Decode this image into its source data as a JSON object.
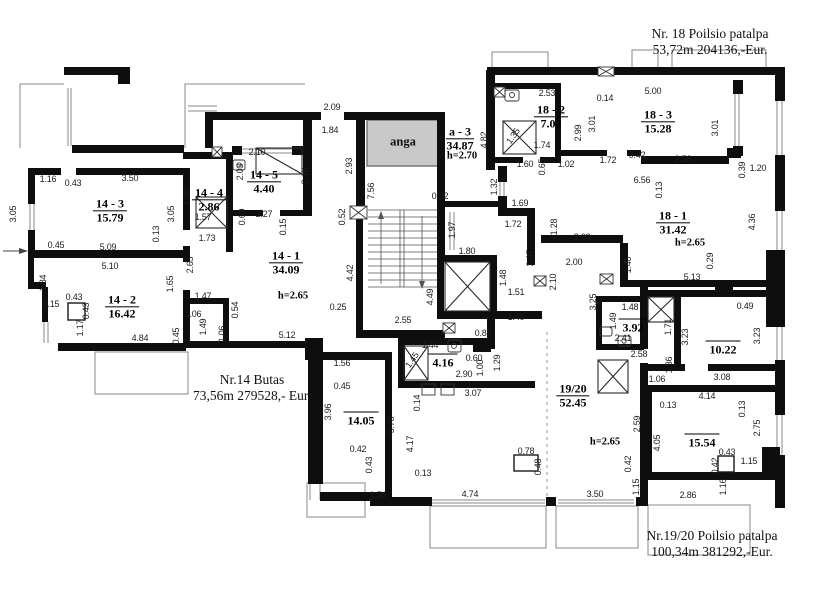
{
  "annotations": {
    "nr14": {
      "line1": "Nr.14 Butas",
      "line2": "73,56m 279528,- Eur."
    },
    "nr18": {
      "line1": "Nr. 18 Poilsio patalpa",
      "line2": "53,72m  204136,-Eur."
    },
    "nr1920": {
      "line1": "Nr.19/20 Poilsio patalpa",
      "line2": "100,34m  381292,-Eur."
    }
  },
  "niche": {
    "label": "anga",
    "x": 403,
    "y": 142
  },
  "rooms": [
    {
      "name": "14 - 3",
      "area": "15.79",
      "x": 110,
      "y": 211
    },
    {
      "name": "14 - 4",
      "area": "2.86",
      "x": 209,
      "y": 200
    },
    {
      "name": "14 - 5",
      "area": "4.40",
      "x": 264,
      "y": 182
    },
    {
      "name": "14 - 2",
      "area": "16.42",
      "x": 122,
      "y": 307
    },
    {
      "name": "14 - 1",
      "area": "34.09",
      "x": 286,
      "y": 263
    },
    {
      "name": "a - 3",
      "area": "34.87",
      "x": 460,
      "y": 139
    },
    {
      "name": "18 - 2",
      "area": "7.02",
      "x": 551,
      "y": 117
    },
    {
      "name": "18 - 3",
      "area": "15.28",
      "x": 658,
      "y": 122
    },
    {
      "name": "18 - 1",
      "area": "31.42",
      "x": 673,
      "y": 223
    },
    {
      "name": "19/20",
      "area": "52.45",
      "x": 573,
      "y": 396
    }
  ],
  "room_areas": [
    {
      "area": "14.05",
      "x": 361,
      "y": 420
    },
    {
      "area": "4.16",
      "x": 443,
      "y": 362
    },
    {
      "area": "3.92",
      "x": 633,
      "y": 327
    },
    {
      "area": "10.22",
      "x": 723,
      "y": 349
    },
    {
      "area": "15.54",
      "x": 702,
      "y": 442
    }
  ],
  "heights": [
    {
      "t": "h=2.65",
      "x": 293,
      "y": 296
    },
    {
      "t": "h=2.70",
      "x": 462,
      "y": 156
    },
    {
      "t": "h=2.65",
      "x": 690,
      "y": 243
    },
    {
      "t": "h=2.65",
      "x": 605,
      "y": 442
    }
  ],
  "dimensions": [
    {
      "t": "2.09",
      "x": 332,
      "y": 107
    },
    {
      "t": "1.84",
      "x": 330,
      "y": 130
    },
    {
      "t": "2.93",
      "x": 349,
      "y": 166,
      "r": -90
    },
    {
      "t": "7.56",
      "x": 371,
      "y": 191,
      "r": -90
    },
    {
      "t": "0.22",
      "x": 440,
      "y": 196
    },
    {
      "t": "0.52",
      "x": 342,
      "y": 217,
      "r": -90
    },
    {
      "t": "1.97",
      "x": 452,
      "y": 230,
      "r": -90
    },
    {
      "t": "1.80",
      "x": 467,
      "y": 251
    },
    {
      "t": "4.42",
      "x": 350,
      "y": 273,
      "r": -90
    },
    {
      "t": "0.25",
      "x": 338,
      "y": 307
    },
    {
      "t": "2.55",
      "x": 403,
      "y": 320
    },
    {
      "t": "4.49",
      "x": 430,
      "y": 297,
      "r": -90
    },
    {
      "t": "5.12",
      "x": 287,
      "y": 335
    },
    {
      "t": "1.16",
      "x": 48,
      "y": 179
    },
    {
      "t": "0.43",
      "x": 73,
      "y": 183
    },
    {
      "t": "3.50",
      "x": 130,
      "y": 178
    },
    {
      "t": "3.05",
      "x": 13,
      "y": 214,
      "r": -90
    },
    {
      "t": "3.05",
      "x": 171,
      "y": 214,
      "r": -90
    },
    {
      "t": "0.13",
      "x": 156,
      "y": 234,
      "r": -90
    },
    {
      "t": "0.45",
      "x": 56,
      "y": 245
    },
    {
      "t": "5.09",
      "x": 108,
      "y": 247
    },
    {
      "t": "1.92",
      "x": 187,
      "y": 197,
      "r": -90
    },
    {
      "t": "1.57",
      "x": 203,
      "y": 217
    },
    {
      "t": "1.73",
      "x": 207,
      "y": 238
    },
    {
      "t": "0.69",
      "x": 242,
      "y": 217,
      "r": -90
    },
    {
      "t": "2.27",
      "x": 264,
      "y": 214
    },
    {
      "t": "2.10",
      "x": 257,
      "y": 152
    },
    {
      "t": "2.03",
      "x": 240,
      "y": 172,
      "r": -90
    },
    {
      "t": "2.18",
      "x": 305,
      "y": 176,
      "r": -90
    },
    {
      "t": "0.15",
      "x": 283,
      "y": 227,
      "r": -90
    },
    {
      "t": "5.10",
      "x": 110,
      "y": 266
    },
    {
      "t": "2.65",
      "x": 190,
      "y": 265,
      "r": -90
    },
    {
      "t": "1.84",
      "x": 43,
      "y": 283,
      "r": -90
    },
    {
      "t": "1.65",
      "x": 170,
      "y": 284,
      "r": -90
    },
    {
      "t": "0.43",
      "x": 74,
      "y": 297
    },
    {
      "t": "1.15",
      "x": 51,
      "y": 304
    },
    {
      "t": "0.43",
      "x": 86,
      "y": 311,
      "r": -90
    },
    {
      "t": "1.47",
      "x": 203,
      "y": 296
    },
    {
      "t": "1.06",
      "x": 193,
      "y": 314
    },
    {
      "t": "1.49",
      "x": 203,
      "y": 327,
      "r": -90
    },
    {
      "t": "1.06",
      "x": 222,
      "y": 334,
      "r": -90
    },
    {
      "t": "0.54",
      "x": 235,
      "y": 310,
      "r": -90
    },
    {
      "t": "1.17",
      "x": 80,
      "y": 328,
      "r": -90
    },
    {
      "t": "4.84",
      "x": 140,
      "y": 338
    },
    {
      "t": "0.45",
      "x": 176,
      "y": 336,
      "r": -90
    },
    {
      "t": "4.82",
      "x": 484,
      "y": 140,
      "r": -90
    },
    {
      "t": "2.53",
      "x": 547,
      "y": 93
    },
    {
      "t": "0.14",
      "x": 605,
      "y": 98
    },
    {
      "t": "5.00",
      "x": 653,
      "y": 91
    },
    {
      "t": "1.35",
      "x": 513,
      "y": 136,
      "r": -55
    },
    {
      "t": "1.74",
      "x": 542,
      "y": 145
    },
    {
      "t": "2.99",
      "x": 578,
      "y": 133,
      "r": -90
    },
    {
      "t": "3.01",
      "x": 592,
      "y": 124,
      "r": -90
    },
    {
      "t": "3.01",
      "x": 715,
      "y": 128,
      "r": -90
    },
    {
      "t": "1.60",
      "x": 525,
      "y": 164
    },
    {
      "t": "0.65",
      "x": 542,
      "y": 167,
      "r": -90
    },
    {
      "t": "1.02",
      "x": 566,
      "y": 164
    },
    {
      "t": "1.72",
      "x": 608,
      "y": 160
    },
    {
      "t": "0.42",
      "x": 637,
      "y": 155
    },
    {
      "t": "6.56",
      "x": 642,
      "y": 180
    },
    {
      "t": "2.58",
      "x": 683,
      "y": 159
    },
    {
      "t": "0.13",
      "x": 659,
      "y": 190,
      "r": -90
    },
    {
      "t": "0.39",
      "x": 742,
      "y": 170,
      "r": -90
    },
    {
      "t": "1.20",
      "x": 758,
      "y": 168
    },
    {
      "t": "1.32",
      "x": 494,
      "y": 187,
      "r": -90
    },
    {
      "t": "1.69",
      "x": 520,
      "y": 203
    },
    {
      "t": "1.72",
      "x": 513,
      "y": 224
    },
    {
      "t": "1.28",
      "x": 554,
      "y": 227,
      "r": -90
    },
    {
      "t": "2.63",
      "x": 582,
      "y": 237
    },
    {
      "t": "4.36",
      "x": 752,
      "y": 222,
      "r": -90
    },
    {
      "t": "0.29",
      "x": 710,
      "y": 261,
      "r": -90
    },
    {
      "t": "5.13",
      "x": 692,
      "y": 277
    },
    {
      "t": "0.49",
      "x": 745,
      "y": 306
    },
    {
      "t": "2.97",
      "x": 530,
      "y": 258,
      "r": -90
    },
    {
      "t": "2.00",
      "x": 574,
      "y": 262
    },
    {
      "t": "2.10",
      "x": 553,
      "y": 282,
      "r": -90
    },
    {
      "t": "1.40",
      "x": 628,
      "y": 265,
      "r": -90
    },
    {
      "t": "1.48",
      "x": 503,
      "y": 278,
      "r": -90
    },
    {
      "t": "1.51",
      "x": 516,
      "y": 292
    },
    {
      "t": "3.25",
      "x": 593,
      "y": 302,
      "r": -90
    },
    {
      "t": "1.48",
      "x": 630,
      "y": 307
    },
    {
      "t": "1.40",
      "x": 516,
      "y": 317
    },
    {
      "t": "1.49",
      "x": 613,
      "y": 321,
      "r": -90
    },
    {
      "t": "2.41",
      "x": 623,
      "y": 338
    },
    {
      "t": "2.58",
      "x": 639,
      "y": 354
    },
    {
      "t": "0.87",
      "x": 483,
      "y": 333
    },
    {
      "t": "0.60",
      "x": 474,
      "y": 358
    },
    {
      "t": "1.00",
      "x": 480,
      "y": 368,
      "r": -90
    },
    {
      "t": "1.29",
      "x": 497,
      "y": 363,
      "r": -90
    },
    {
      "t": "1.44",
      "x": 430,
      "y": 345
    },
    {
      "t": "1.45",
      "x": 412,
      "y": 360,
      "r": -55
    },
    {
      "t": "2.90",
      "x": 464,
      "y": 374
    },
    {
      "t": "3.07",
      "x": 473,
      "y": 393
    },
    {
      "t": "0.14",
      "x": 417,
      "y": 403,
      "r": -90
    },
    {
      "t": "5.78",
      "x": 391,
      "y": 425,
      "r": -90
    },
    {
      "t": "4.17",
      "x": 410,
      "y": 444,
      "r": -90
    },
    {
      "t": "0.13",
      "x": 423,
      "y": 473
    },
    {
      "t": "1.56",
      "x": 342,
      "y": 363
    },
    {
      "t": "0.45",
      "x": 342,
      "y": 386
    },
    {
      "t": "3.96",
      "x": 328,
      "y": 412,
      "r": -90
    },
    {
      "t": "0.42",
      "x": 358,
      "y": 449
    },
    {
      "t": "0.43",
      "x": 369,
      "y": 465,
      "r": -90
    },
    {
      "t": "1.54",
      "x": 378,
      "y": 495
    },
    {
      "t": "0.78",
      "x": 526,
      "y": 451
    },
    {
      "t": "0.48",
      "x": 538,
      "y": 467,
      "r": -90
    },
    {
      "t": "4.74",
      "x": 470,
      "y": 494
    },
    {
      "t": "3.50",
      "x": 595,
      "y": 494
    },
    {
      "t": "2.59",
      "x": 637,
      "y": 424,
      "r": -90
    },
    {
      "t": "0.42",
      "x": 628,
      "y": 464,
      "r": -90
    },
    {
      "t": "1.15",
      "x": 636,
      "y": 487,
      "r": -90
    },
    {
      "t": "3.23",
      "x": 685,
      "y": 337,
      "r": -90
    },
    {
      "t": "3.23",
      "x": 757,
      "y": 336,
      "r": -90
    },
    {
      "t": "1.71",
      "x": 668,
      "y": 327,
      "r": -90
    },
    {
      "t": "1.36",
      "x": 669,
      "y": 365,
      "r": -90
    },
    {
      "t": "1.06",
      "x": 657,
      "y": 379
    },
    {
      "t": "3.08",
      "x": 722,
      "y": 377
    },
    {
      "t": "4.14",
      "x": 707,
      "y": 396
    },
    {
      "t": "0.13",
      "x": 668,
      "y": 405
    },
    {
      "t": "0.13",
      "x": 742,
      "y": 409,
      "r": -90
    },
    {
      "t": "2.75",
      "x": 757,
      "y": 428,
      "r": -90
    },
    {
      "t": "4.05",
      "x": 657,
      "y": 443,
      "r": -90
    },
    {
      "t": "0.43",
      "x": 727,
      "y": 452
    },
    {
      "t": "1.15",
      "x": 749,
      "y": 461
    },
    {
      "t": "0.42",
      "x": 715,
      "y": 466,
      "r": -90
    },
    {
      "t": "1.16",
      "x": 723,
      "y": 487,
      "r": -90
    },
    {
      "t": "2.86",
      "x": 688,
      "y": 495
    }
  ],
  "colors": {
    "wall": "#0e0e0e",
    "niche_fill": "#c9c9c9",
    "thin_line": "#8a8a8a",
    "dash": "#9a9a9a",
    "background": "#ffffff"
  }
}
